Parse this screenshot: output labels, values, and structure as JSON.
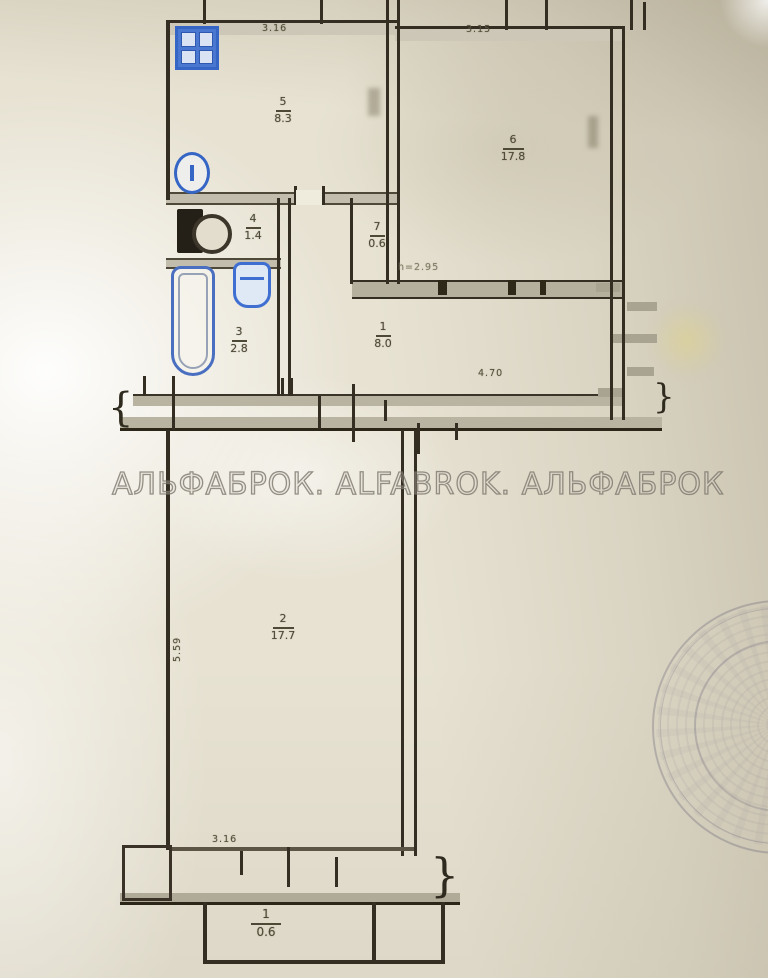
{
  "watermark": {
    "text": "АЛЬФАБРОК. ALFABROK. АЛЬФАБРОК"
  },
  "rooms": {
    "kitchen": {
      "number": "5",
      "area": "8.3"
    },
    "living": {
      "number": "6",
      "area": "17.8"
    },
    "laundry": {
      "number": "4",
      "area": "1.4"
    },
    "closet": {
      "number": "7",
      "area": "0.6"
    },
    "bath": {
      "number": "3",
      "area": "2.8"
    },
    "hall": {
      "number": "1",
      "area": "8.0"
    },
    "room2": {
      "number": "2",
      "area": "17.7"
    },
    "balcony": {
      "number": "1",
      "area": "0.6"
    }
  },
  "dimensions": {
    "kitchen_top_width": "3.16",
    "living_top_width": "3.15",
    "hall_width": "4.70",
    "room2_left_height": "5.59",
    "room2_bottom_width": "3.16",
    "ceiling_height": "h=2.95"
  },
  "symbols": {
    "brace_left": "{",
    "brace_right": "}"
  },
  "fixtures": {
    "stove": "gas-stove-icon",
    "sink": "sink-icon",
    "washer": "washing-machine-icon",
    "toilet": "toilet-icon",
    "bathtub": "bathtub-icon"
  },
  "colors": {
    "wall": "#342d22",
    "wall_band": "#b9b3a1",
    "fixture_blue": "#3565c5",
    "label_text": "#4e4936",
    "watermark_gray": "#8f8b80",
    "paper": "#e7e2d2"
  }
}
